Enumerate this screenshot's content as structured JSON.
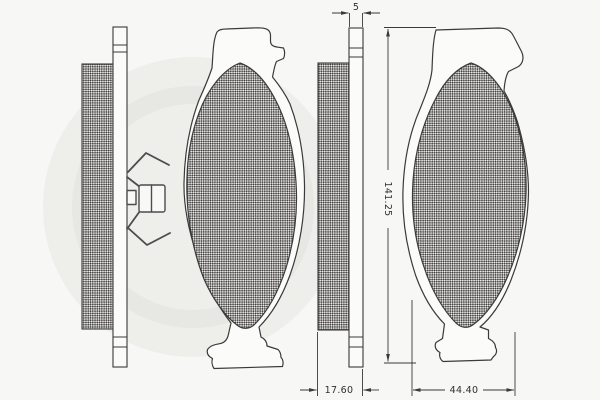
{
  "drawing": {
    "dimensions": {
      "plate_thickness": "5",
      "pad_height": "141.25",
      "pad_total_thickness": "17.60",
      "pad_width": "44.40"
    },
    "colors": {
      "line": "#3a3a3a",
      "paper": "#f7f7f5",
      "hatch_dark": "#3f3e3c",
      "hatch_light": "#efeeec",
      "watermark": "#eeeeeb"
    }
  }
}
